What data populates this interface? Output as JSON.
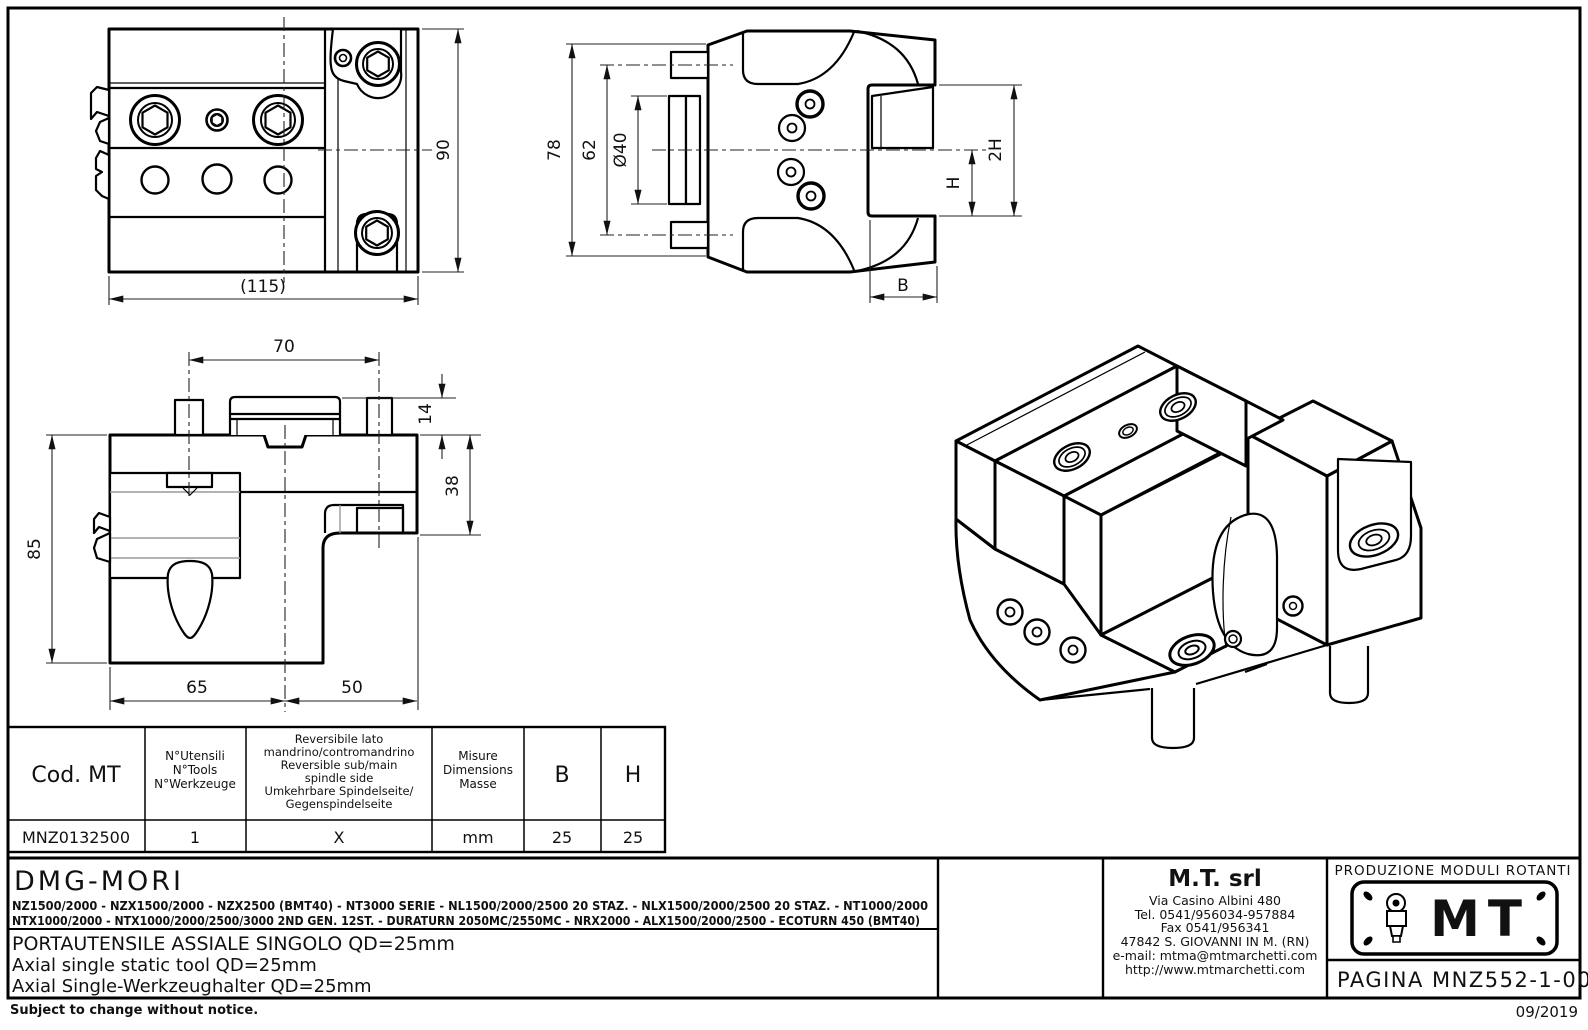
{
  "views": {
    "front": {
      "dim_width": "(115)",
      "dim_height": "90"
    },
    "side": {
      "dim_total": "78",
      "dim_pins": "62",
      "dim_spigot": "Ø40",
      "dim_h": "H",
      "dim_2h": "2H",
      "dim_b": "B"
    },
    "profile": {
      "dim_top": "70",
      "dim_step": "14",
      "dim_right": "38",
      "dim_left": "85",
      "dim_bottom_left": "65",
      "dim_bottom_right": "50"
    }
  },
  "table": {
    "headers": {
      "code": "Cod. MT",
      "tools": [
        "N°Utensili",
        "N°Tools",
        "N°Werkzeuge"
      ],
      "reversible": [
        "Reversibile lato",
        "mandrino/contromandrino",
        "Reversible sub/main",
        "spindle side",
        "Umkehrbare Spindelseite/",
        "Gegenspindelseite"
      ],
      "units": [
        "Misure",
        "Dimensions",
        "Masse"
      ],
      "b": "B",
      "h": "H"
    },
    "row": {
      "code": "MNZ0132500",
      "tools": "1",
      "reversible": "X",
      "units": "mm",
      "b": "25",
      "h": "25"
    }
  },
  "title_block": {
    "brand": "DMG-MORI",
    "machines_line1": "NZ1500/2000 - NZX1500/2000 -  NZX2500 (BMT40) - NT3000 SERIE - NL1500/2000/2500 20 STAZ. - NLX1500/2000/2500 20 STAZ. - NT1000/2000",
    "machines_line2": "NTX1000/2000 - NTX1000/2000/2500/3000 2ND GEN. 12ST. - DURATURN 2050MC/2550MC - NRX2000 - ALX1500/2000/2500 - ECOTURN 450 (BMT40)",
    "title_it": "PORTAUTENSILE ASSIALE SINGOLO QD=25mm",
    "title_en": "Axial single static tool QD=25mm",
    "title_de": "Axial Single-Werkzeughalter QD=25mm",
    "company": {
      "name": "M.T. srl",
      "lines": [
        "Via Casino Albini 480",
        "Tel. 0541/956034-957884",
        "Fax 0541/956341",
        "47842 S. GIOVANNI IN M. (RN)",
        "e-mail: mtma@mtmarchetti.com",
        "http://www.mtmarchetti.com"
      ]
    },
    "production": "PRODUZIONE MODULI ROTANTI",
    "logo": "MT",
    "page": "PAGINA MNZ552-1-00",
    "note": "Subject to change without notice.",
    "date": "09/2019"
  }
}
